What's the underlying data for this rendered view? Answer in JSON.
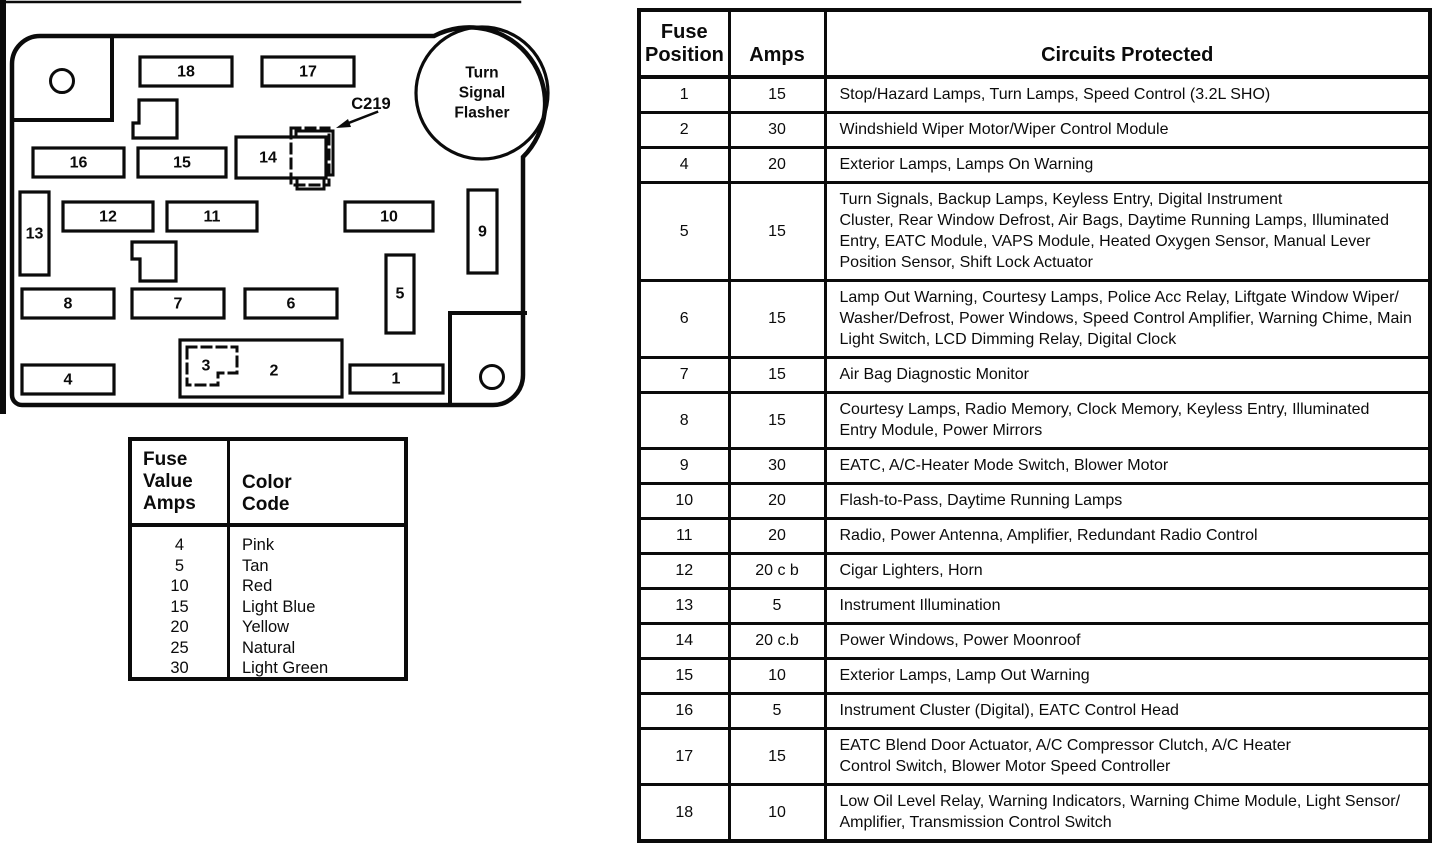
{
  "diagram": {
    "flasher_lines": [
      "Turn",
      "Signal",
      "Flasher"
    ],
    "connector_label": "C219",
    "fuse_labels": [
      "1",
      "2",
      "3",
      "4",
      "5",
      "6",
      "7",
      "8",
      "9",
      "10",
      "11",
      "12",
      "13",
      "14",
      "15",
      "16",
      "17",
      "18"
    ]
  },
  "color_table": {
    "col1_header": "Fuse\nValue\nAmps",
    "col2_header": "Color\nCode",
    "rows": [
      {
        "amps": "4",
        "color": "Pink"
      },
      {
        "amps": "5",
        "color": "Tan"
      },
      {
        "amps": "10",
        "color": "Red"
      },
      {
        "amps": "15",
        "color": "Light Blue"
      },
      {
        "amps": "20",
        "color": "Yellow"
      },
      {
        "amps": "25",
        "color": "Natural"
      },
      {
        "amps": "30",
        "color": "Light Green"
      }
    ]
  },
  "fuse_table": {
    "col_headers": {
      "position": "Fuse\nPosition",
      "amps": "Amps",
      "circuits": "Circuits Protected"
    },
    "rows": [
      {
        "position": "1",
        "amps": "15",
        "circuits": "Stop/Hazard Lamps, Turn Lamps, Speed Control (3.2L SHO)"
      },
      {
        "position": "2",
        "amps": "30",
        "circuits": "Windshield Wiper Motor/Wiper Control Module"
      },
      {
        "position": "4",
        "amps": "20",
        "circuits": "Exterior Lamps, Lamps On Warning"
      },
      {
        "position": "5",
        "amps": "15",
        "circuits": "Turn Signals, Backup Lamps, Keyless Entry, Digital Instrument\nCluster, Rear Window Defrost, Air Bags, Daytime Running Lamps, Illuminated\nEntry, EATC Module, VAPS Module, Heated Oxygen Sensor, Manual Lever\nPosition Sensor, Shift Lock Actuator"
      },
      {
        "position": "6",
        "amps": "15",
        "circuits": "Lamp Out Warning, Courtesy Lamps, Police Acc Relay, Liftgate Window Wiper/\nWasher/Defrost, Power Windows, Speed Control Amplifier, Warning Chime, Main\nLight Switch, LCD Dimming Relay, Digital Clock"
      },
      {
        "position": "7",
        "amps": "15",
        "circuits": "Air Bag Diagnostic Monitor"
      },
      {
        "position": "8",
        "amps": "15",
        "circuits": "Courtesy Lamps, Radio Memory, Clock Memory, Keyless Entry, Illuminated\nEntry Module, Power Mirrors"
      },
      {
        "position": "9",
        "amps": "30",
        "circuits": "EATC, A/C-Heater Mode Switch, Blower Motor"
      },
      {
        "position": "10",
        "amps": "20",
        "circuits": "Flash-to-Pass, Daytime Running Lamps"
      },
      {
        "position": "11",
        "amps": "20",
        "circuits": "Radio, Power Antenna, Amplifier, Redundant Radio Control"
      },
      {
        "position": "12",
        "amps": "20 c b",
        "circuits": "Cigar Lighters, Horn"
      },
      {
        "position": "13",
        "amps": "5",
        "circuits": "Instrument Illumination"
      },
      {
        "position": "14",
        "amps": "20 c.b",
        "circuits": "Power Windows, Power Moonroof"
      },
      {
        "position": "15",
        "amps": "10",
        "circuits": "Exterior Lamps, Lamp Out Warning"
      },
      {
        "position": "16",
        "amps": "5",
        "circuits": "Instrument Cluster (Digital), EATC Control Head"
      },
      {
        "position": "17",
        "amps": "15",
        "circuits": "EATC Blend Door Actuator, A/C Compressor Clutch, A/C Heater\nControl Switch, Blower Motor Speed Controller"
      },
      {
        "position": "18",
        "amps": "10",
        "circuits": "Low Oil Level Relay, Warning Indicators, Warning Chime Module, Light Sensor/\nAmplifier, Transmission Control Switch"
      }
    ]
  }
}
